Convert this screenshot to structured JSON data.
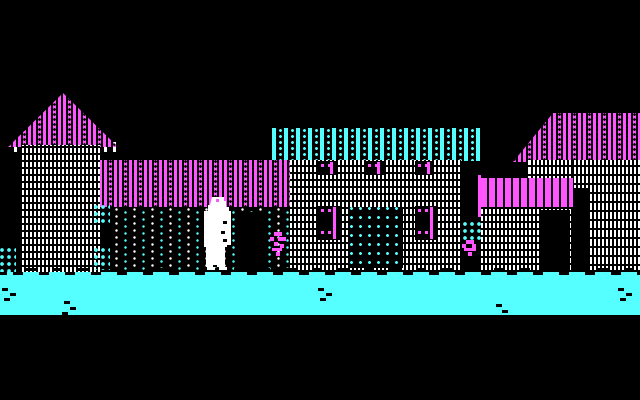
{
  "meta": {
    "kind": "retro adventure game scene",
    "style": "CGA 4-color village street",
    "resolution": "640x400"
  },
  "palette": {
    "black": "#000000",
    "white": "#FFFFFF",
    "cyan": "#55FFFF",
    "magenta": "#FF55FF"
  },
  "scene": {
    "objects": {
      "tower": {
        "name": "tower with pointed magenta roof"
      },
      "tower_roof": {
        "name": "pointed dithered magenta roof"
      },
      "shop_house": {
        "name": "house with magenta roof and dark porch"
      },
      "shop_roof": {
        "name": "dithered magenta roof band"
      },
      "shop_door": {
        "name": "dark porch doorway"
      },
      "inn": {
        "name": "building with cyan slat awning"
      },
      "inn_awning": {
        "name": "cyan slat awning"
      },
      "inn_door": {
        "name": "screen door with cyan lattice"
      },
      "inn_window": {
        "name": "shuttered window with magenta trim"
      },
      "right_house": {
        "name": "large house with dithered magenta roof"
      },
      "right_awning": {
        "name": "bright magenta awning"
      },
      "right_door_inner": {
        "name": "dark doorway under awning"
      },
      "right_door_outer": {
        "name": "dark doorway of right house"
      },
      "sign_pole": {
        "name": "magenta sign pole"
      },
      "villager": {
        "name": "villager in white robes"
      },
      "flower_left": {
        "name": "magenta flowers"
      },
      "flower_right": {
        "name": "magenta flowers"
      },
      "bush": {
        "name": "cyan shrub"
      },
      "street": {
        "name": "cyan street"
      },
      "sky": {
        "name": "night sky"
      }
    }
  }
}
